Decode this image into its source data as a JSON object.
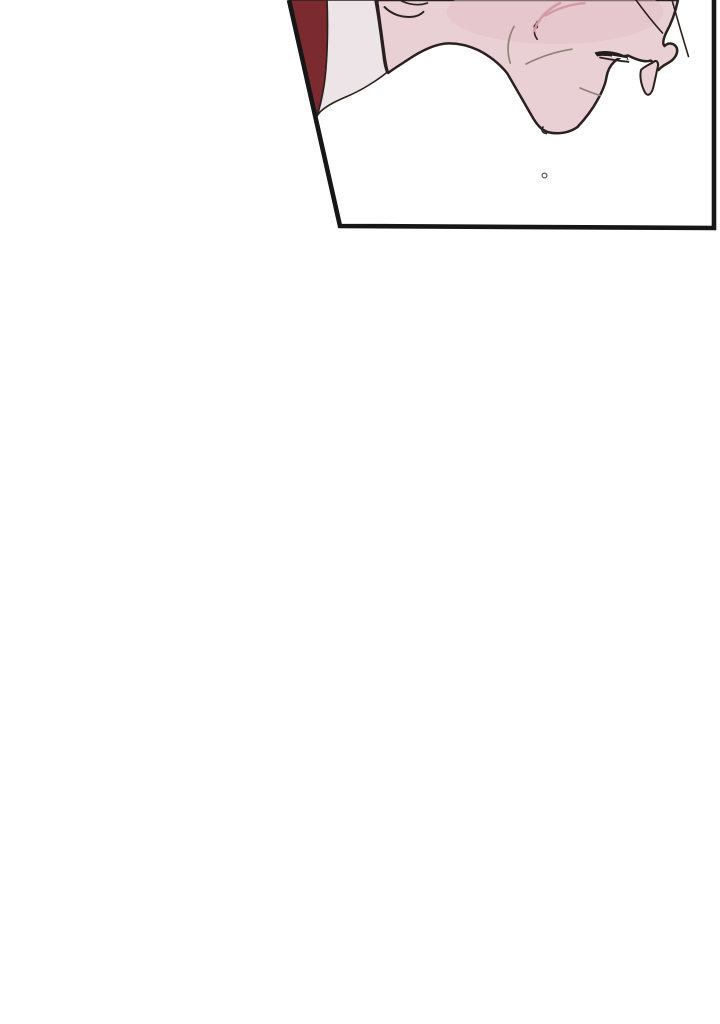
{
  "scene": {
    "type": "webtoon-comic-panel",
    "description": "Cropped top sliver of a comic panel: lower part of a character's face in profile (jaw, chin, slightly open mouth, neck) in pale pink tones, a dark red wedge of hair at the left edge and a pale shirt collar; slanted black panel border; large blank white space fills the rest of the page.",
    "panel_shape": "quadrilateral with slanted left edge",
    "text_content": "none",
    "droplet_mark": "small circle below the chin inside the panel"
  },
  "colors": {
    "page_background": "#ffffff",
    "panel_background": "#ffffff",
    "panel_border": "#161616",
    "hair_wedge": "#7b2b2f",
    "collar": "#ece4e6",
    "skin": "#e9d0d5",
    "blush_tint": "#e2bdc5",
    "blush_stroke": "#d39aa4",
    "line_art": "#2a211e",
    "soft_detail_line": "#8e837c",
    "mouth_shadow": "#241d1b",
    "mouth_gap": "#ffffff",
    "droplet_stroke": "#5c5c5c",
    "droplet_fill": "#ffffff"
  }
}
